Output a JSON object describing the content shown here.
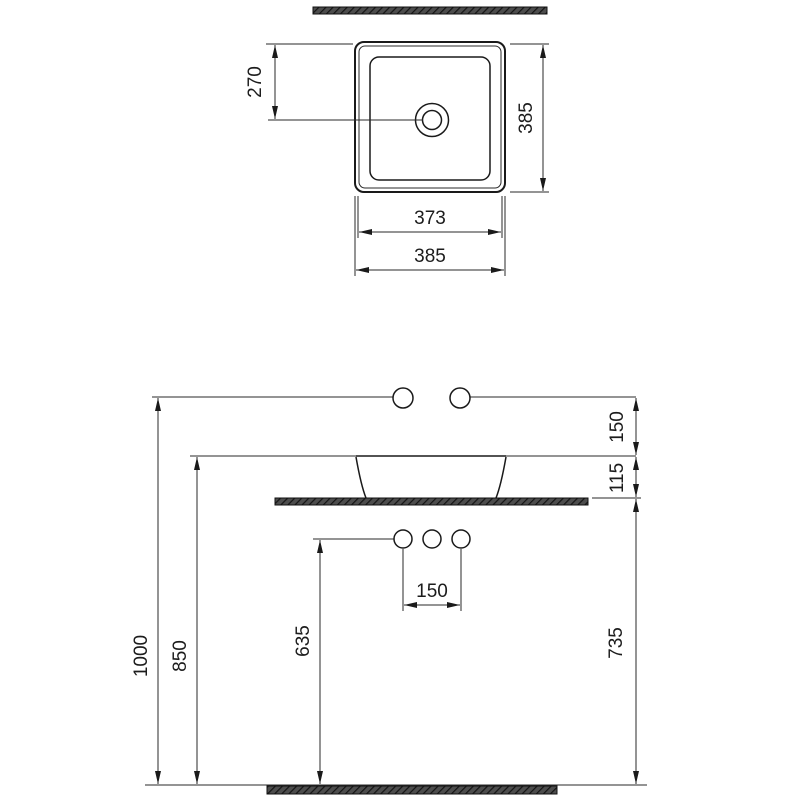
{
  "page": {
    "background": "#ffffff",
    "line_color": "#1c1c1c",
    "hatch_color": "#4d4d4d"
  },
  "top_view": {
    "name": "washbasin-plan-view",
    "dim_drain_from_edge": "270",
    "dim_depth": "385",
    "dim_inner_width": "373",
    "dim_outer_width": "385"
  },
  "front_view": {
    "name": "washbasin-front-elevation",
    "dim_total_height": "1000",
    "dim_rim_height": "850",
    "dim_supply_height": "635",
    "dim_counter_height": "735",
    "dim_faucet_above_rim": "150",
    "dim_rim_to_counter": "115",
    "dim_supply_spacing": "150"
  }
}
